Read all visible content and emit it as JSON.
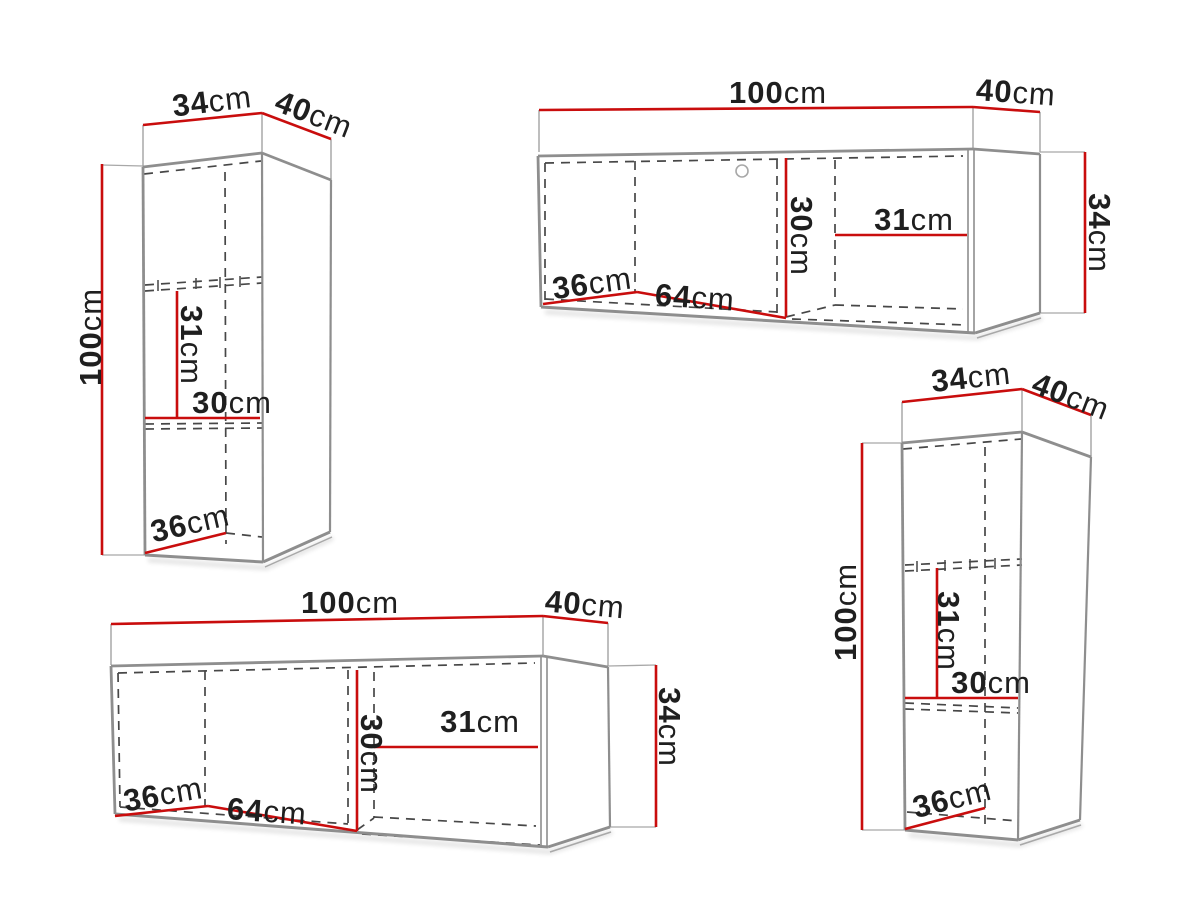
{
  "colors": {
    "red": "#c90d0d",
    "outline": "#8e8e8e",
    "outline_light": "#a8a8a8",
    "dashed": "#474747",
    "text": "#1f1f1f",
    "background": "#ffffff"
  },
  "cabinets": [
    {
      "id": "cabinet-top-left",
      "kind": "tall-wall-cabinet",
      "dimensions": {
        "width": {
          "num": "34",
          "unit": "cm"
        },
        "depth": {
          "num": "40",
          "unit": "cm"
        },
        "height": {
          "num": "100",
          "unit": "cm"
        },
        "inner_upper": {
          "num": "31",
          "unit": "cm"
        },
        "inner_width": {
          "num": "30",
          "unit": "cm"
        },
        "inner_depth": {
          "num": "36",
          "unit": "cm"
        }
      }
    },
    {
      "id": "cabinet-top-right",
      "kind": "wide-wall-cabinet",
      "dimensions": {
        "width": {
          "num": "100",
          "unit": "cm"
        },
        "depth": {
          "num": "40",
          "unit": "cm"
        },
        "height": {
          "num": "34",
          "unit": "cm"
        },
        "inner_height": {
          "num": "30",
          "unit": "cm"
        },
        "inner_right": {
          "num": "31",
          "unit": "cm"
        },
        "inner_depth": {
          "num": "36",
          "unit": "cm"
        },
        "inner_middle": {
          "num": "64",
          "unit": "cm"
        }
      }
    },
    {
      "id": "cabinet-bottom-left",
      "kind": "wide-wall-cabinet",
      "dimensions": {
        "width": {
          "num": "100",
          "unit": "cm"
        },
        "depth": {
          "num": "40",
          "unit": "cm"
        },
        "height": {
          "num": "34",
          "unit": "cm"
        },
        "inner_height": {
          "num": "30",
          "unit": "cm"
        },
        "inner_right": {
          "num": "31",
          "unit": "cm"
        },
        "inner_depth": {
          "num": "36",
          "unit": "cm"
        },
        "inner_middle": {
          "num": "64",
          "unit": "cm"
        }
      }
    },
    {
      "id": "cabinet-bottom-right",
      "kind": "tall-wall-cabinet",
      "dimensions": {
        "width": {
          "num": "34",
          "unit": "cm"
        },
        "depth": {
          "num": "40",
          "unit": "cm"
        },
        "height": {
          "num": "100",
          "unit": "cm"
        },
        "inner_upper": {
          "num": "31",
          "unit": "cm"
        },
        "inner_width": {
          "num": "30",
          "unit": "cm"
        },
        "inner_depth": {
          "num": "36",
          "unit": "cm"
        }
      }
    }
  ]
}
